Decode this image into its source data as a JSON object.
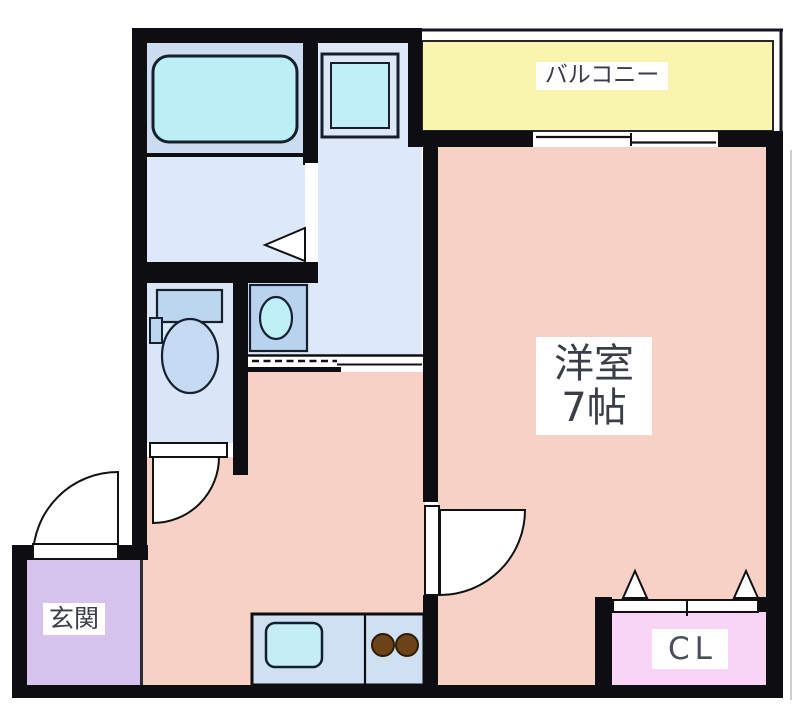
{
  "plan": {
    "type": "apartment-floor-plan",
    "labels": {
      "balcony": "バルコニー",
      "main_room_name": "洋室",
      "main_room_size": "7帖",
      "entrance": "玄関",
      "closet": "CL"
    },
    "rooms": [
      {
        "name": "balcony",
        "label": "バルコニー"
      },
      {
        "name": "main-room",
        "label": "洋室 7帖"
      },
      {
        "name": "bathroom",
        "label": ""
      },
      {
        "name": "washroom",
        "label": ""
      },
      {
        "name": "toilet-room",
        "label": ""
      },
      {
        "name": "hallway-kitchen",
        "label": ""
      },
      {
        "name": "entrance",
        "label": "玄関"
      },
      {
        "name": "closet",
        "label": "CL"
      }
    ],
    "fixtures": [
      "bathtub",
      "washing-machine-pan",
      "toilet",
      "washbasin",
      "kitchen-counter",
      "kitchen-sink",
      "gas-stove-burners",
      "hinged-doors",
      "sliding-door",
      "sliding-window",
      "closet-folding-door"
    ],
    "colors": {
      "wall": "#0d0d12",
      "balcony": "#f9f5ae",
      "main_room": "#f7d1c5",
      "hallway": "#f7d1c5",
      "bathroom_upper": "#ccddf2",
      "washroom": "#dde9f8",
      "toilet_room": "#d9e6f7",
      "entrance": "#d6c4ef",
      "closet": "#f8d5f5",
      "fixture_cyan": "#bfeef6",
      "fixture_blue": "#bcd6f0",
      "counter": "#cfe0f3",
      "burner": "#6d4418",
      "label_text": "#3a3e47"
    }
  }
}
